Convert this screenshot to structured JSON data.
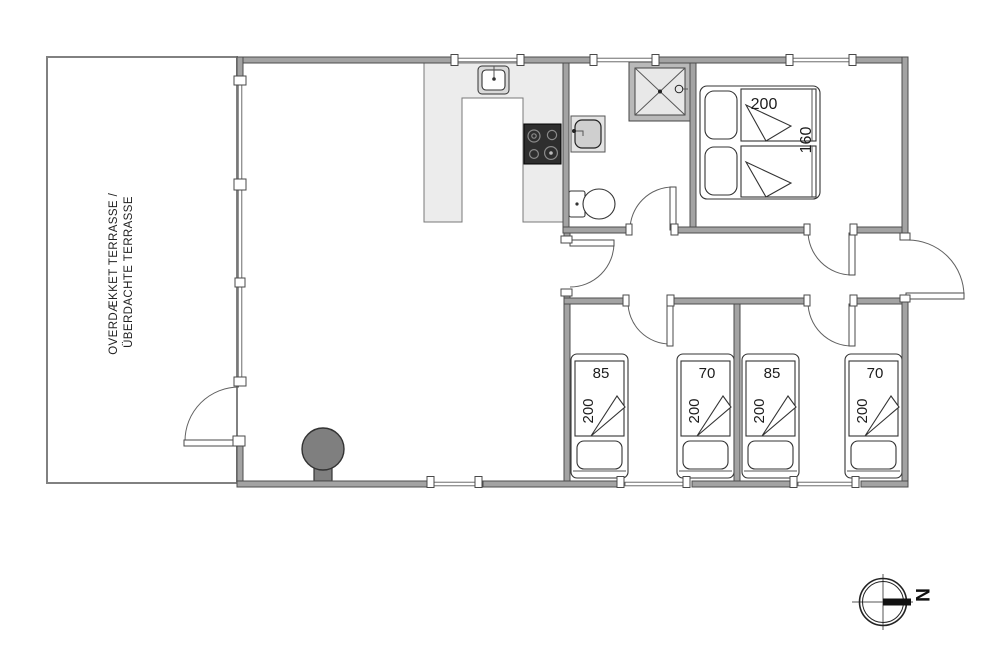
{
  "colors": {
    "wall": "#a3a3a3",
    "wall_outline": "#4d4d4d",
    "counter": "#ececec",
    "stove": "#2e2e2e",
    "wood_stove": "#7f7f7f",
    "shower_tray": "#e8e8e8",
    "floor": "#ffffff"
  },
  "terrace": {
    "line1": "OVERDÆKKET TERRASSE /",
    "line2": "ÜBERDACHTE TERRASSE"
  },
  "double_bed": {
    "top_label": "200",
    "side_label": "160"
  },
  "beds": [
    {
      "width_label": "85",
      "length_label": "200"
    },
    {
      "width_label": "70",
      "length_label": "200"
    },
    {
      "width_label": "85",
      "length_label": "200"
    },
    {
      "width_label": "70",
      "length_label": "200"
    }
  ],
  "compass": {
    "north_label": "N"
  },
  "fixture_icons": [
    "kitchen-sink-icon",
    "stove-icon",
    "bathroom-sink-icon",
    "toilet-icon",
    "shower-icon",
    "wood-stove-icon",
    "double-bed-icon",
    "single-bed-icon",
    "compass-icon"
  ]
}
